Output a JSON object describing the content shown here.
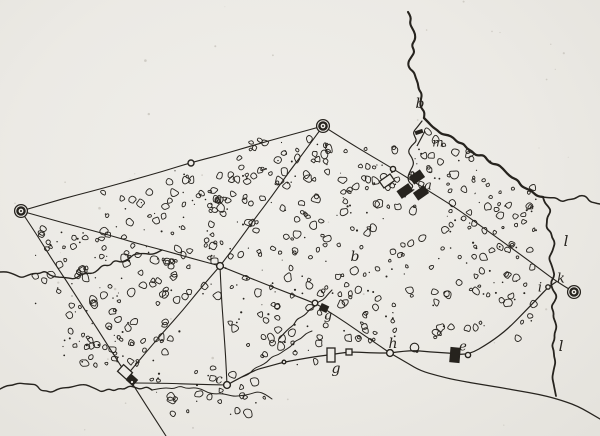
{
  "figure": {
    "kind": "hand-drawn-survey-sketch-map",
    "width": 600,
    "height": 436
  },
  "colors": {
    "paper": "#edebe6",
    "ink": "#26231e",
    "speckle": "#cfccc5"
  },
  "labels": [
    {
      "text": "a",
      "x": 428,
      "y": 186,
      "size": 13
    },
    {
      "text": "b",
      "x": 420,
      "y": 104,
      "size": 14
    },
    {
      "text": "b",
      "x": 355,
      "y": 257,
      "size": 14
    },
    {
      "text": "c",
      "x": 219,
      "y": 380,
      "size": 13
    },
    {
      "text": "g",
      "x": 328,
      "y": 316,
      "size": 13
    },
    {
      "text": "e",
      "x": 463,
      "y": 347,
      "size": 13
    },
    {
      "text": "g",
      "x": 336,
      "y": 369,
      "size": 14
    },
    {
      "text": "h",
      "x": 393,
      "y": 344,
      "size": 14
    },
    {
      "text": "i",
      "x": 540,
      "y": 288,
      "size": 13
    },
    {
      "text": "k",
      "x": 561,
      "y": 279,
      "size": 13
    },
    {
      "text": "l",
      "x": 566,
      "y": 242,
      "size": 15
    },
    {
      "text": "l",
      "x": 561,
      "y": 347,
      "size": 15
    },
    {
      "text": "m",
      "x": 438,
      "y": 143,
      "size": 12
    }
  ],
  "stations": [
    {
      "x": 21,
      "y": 211
    },
    {
      "x": 323,
      "y": 126
    },
    {
      "x": 574,
      "y": 292
    }
  ],
  "nodes": [
    {
      "x": 191,
      "y": 163,
      "r": 3.0
    },
    {
      "x": 393,
      "y": 169,
      "r": 2.6
    },
    {
      "x": 220,
      "y": 266,
      "r": 3.4
    },
    {
      "x": 227,
      "y": 385,
      "r": 3.4
    },
    {
      "x": 390,
      "y": 353,
      "r": 3.4
    },
    {
      "x": 468,
      "y": 355,
      "r": 2.6
    },
    {
      "x": 315,
      "y": 303,
      "r": 2.8
    },
    {
      "x": 548,
      "y": 287,
      "r": 2.2
    },
    {
      "x": 284,
      "y": 362,
      "r": 1.8
    },
    {
      "x": 132,
      "y": 382,
      "r": 1.8
    }
  ],
  "survey_lines": [
    {
      "pts": [
        [
          21,
          211
        ],
        [
          191,
          163
        ],
        [
          323,
          126
        ]
      ]
    },
    {
      "pts": [
        [
          21,
          211
        ],
        [
          220,
          266
        ]
      ]
    },
    {
      "pts": [
        [
          21,
          211
        ],
        [
          127,
          375
        ],
        [
          166,
          436
        ]
      ]
    },
    {
      "pts": [
        [
          323,
          126
        ],
        [
          220,
          266
        ]
      ]
    },
    {
      "pts": [
        [
          323,
          126
        ],
        [
          393,
          169
        ],
        [
          456,
          208
        ],
        [
          556,
          281
        ],
        [
          574,
          292
        ]
      ]
    },
    {
      "pts": [
        [
          220,
          266
        ],
        [
          315,
          303
        ],
        [
          324,
          308
        ],
        [
          390,
          353
        ]
      ]
    },
    {
      "pts": [
        [
          220,
          266
        ],
        [
          227,
          385
        ]
      ]
    },
    {
      "pts": [
        [
          220,
          266
        ],
        [
          127,
          375
        ]
      ]
    },
    {
      "pts": [
        [
          135,
          383
        ],
        [
          227,
          385
        ]
      ]
    }
  ],
  "roads": [
    {
      "pts": [
        [
          227,
          385
        ],
        [
          252,
          371
        ],
        [
          284,
          362
        ],
        [
          310,
          357
        ],
        [
          331,
          355
        ],
        [
          349,
          352
        ],
        [
          390,
          353
        ]
      ]
    },
    {
      "pts": [
        [
          390,
          353
        ],
        [
          410,
          350
        ],
        [
          430,
          352
        ],
        [
          468,
          355
        ],
        [
          490,
          343
        ],
        [
          508,
          329
        ],
        [
          524,
          312
        ],
        [
          538,
          298
        ],
        [
          548,
          287
        ],
        [
          556,
          282
        ]
      ]
    },
    {
      "pts": [
        [
          390,
          353
        ],
        [
          408,
          363
        ],
        [
          420,
          371
        ],
        [
          455,
          380
        ],
        [
          487,
          386
        ],
        [
          520,
          391
        ],
        [
          556,
          398
        ],
        [
          577,
          406
        ],
        [
          600,
          419
        ]
      ]
    }
  ],
  "streams": [
    {
      "name": "stream-b-upper",
      "w": 2.1,
      "amp": 3.4,
      "pts": [
        [
          408,
          12
        ],
        [
          415,
          40
        ],
        [
          409,
          68
        ],
        [
          420,
          95
        ],
        [
          424,
          118
        ]
      ]
    },
    {
      "name": "river-main",
      "w": 2.3,
      "amp": 2.8,
      "pts": [
        [
          424,
          118
        ],
        [
          443,
          133
        ],
        [
          468,
          147
        ],
        [
          492,
          163
        ],
        [
          517,
          181
        ],
        [
          543,
          197
        ]
      ]
    },
    {
      "name": "river-east-arm",
      "w": 1.5,
      "amp": 2.6,
      "pts": [
        [
          543,
          197
        ],
        [
          562,
          201
        ],
        [
          580,
          196
        ],
        [
          600,
          204
        ]
      ]
    },
    {
      "name": "river-l-south",
      "w": 1.8,
      "amp": 2.2,
      "pts": [
        [
          543,
          197
        ],
        [
          549,
          212
        ],
        [
          547,
          228
        ],
        [
          553,
          243
        ],
        [
          549,
          258
        ],
        [
          555,
          270
        ],
        [
          552,
          282
        ],
        [
          555,
          296
        ],
        [
          552,
          312
        ],
        [
          556,
          328
        ],
        [
          552,
          345
        ],
        [
          556,
          362
        ],
        [
          553,
          378
        ],
        [
          556,
          396
        ]
      ]
    },
    {
      "name": "village-brook",
      "w": 1.2,
      "amp": 1.8,
      "pts": [
        [
          422,
          121
        ],
        [
          412,
          131
        ],
        [
          417,
          141
        ],
        [
          408,
          152
        ],
        [
          414,
          164
        ],
        [
          407,
          176
        ],
        [
          413,
          187
        ],
        [
          405,
          197
        ]
      ]
    },
    {
      "name": "left-stream",
      "w": 1.4,
      "amp": 2.6,
      "pts": [
        [
          0,
          272
        ],
        [
          22,
          277
        ],
        [
          45,
          271
        ],
        [
          68,
          280
        ],
        [
          92,
          272
        ],
        [
          115,
          262
        ],
        [
          140,
          255
        ],
        [
          162,
          250
        ]
      ]
    },
    {
      "name": "bottom-stream",
      "w": 1.4,
      "amp": 2.6,
      "pts": [
        [
          0,
          389
        ],
        [
          25,
          384
        ],
        [
          52,
          391
        ],
        [
          80,
          385
        ],
        [
          108,
          391
        ],
        [
          135,
          386
        ],
        [
          152,
          390
        ]
      ]
    },
    {
      "name": "creek-g",
      "w": 1.1,
      "amp": 1.8,
      "pts": [
        [
          332,
          290
        ],
        [
          318,
          303
        ],
        [
          302,
          317
        ],
        [
          289,
          328
        ],
        [
          279,
          339
        ]
      ]
    }
  ],
  "wood_edges": [
    {
      "pts": [
        [
          152,
          390
        ],
        [
          180,
          386
        ],
        [
          208,
          393
        ],
        [
          235,
          396
        ],
        [
          258,
          391
        ],
        [
          272,
          399
        ]
      ]
    },
    {
      "pts": [
        [
          242,
          377
        ],
        [
          266,
          361
        ],
        [
          290,
          346
        ],
        [
          312,
          331
        ]
      ]
    }
  ],
  "buildings": [
    {
      "x": 387,
      "y": 181,
      "w": 13,
      "h": 8,
      "a": -35,
      "fill": "white"
    },
    {
      "x": 405,
      "y": 191,
      "w": 13,
      "h": 8,
      "a": -35,
      "fill": "black"
    },
    {
      "x": 417,
      "y": 177,
      "w": 12,
      "h": 8,
      "a": -35,
      "fill": "black"
    },
    {
      "x": 421,
      "y": 193,
      "w": 12,
      "h": 8,
      "a": -35,
      "fill": "black"
    },
    {
      "x": 455,
      "y": 355,
      "w": 9,
      "h": 14,
      "a": 5,
      "fill": "black"
    },
    {
      "x": 331,
      "y": 355,
      "w": 8,
      "h": 14,
      "a": 0,
      "fill": "white"
    },
    {
      "x": 349,
      "y": 352,
      "w": 6,
      "h": 6,
      "a": 0,
      "fill": "white"
    },
    {
      "x": 324,
      "y": 308,
      "w": 7,
      "h": 6,
      "a": 25,
      "fill": "black"
    },
    {
      "x": 125,
      "y": 372,
      "w": 12,
      "h": 9,
      "a": 42,
      "fill": "white"
    },
    {
      "x": 132,
      "y": 380,
      "w": 8,
      "h": 7,
      "a": 42,
      "fill": "black"
    }
  ],
  "flag_marker": {
    "pole": [
      [
        417,
        146
      ],
      [
        425,
        131
      ]
    ],
    "x": 419,
    "y": 132
  },
  "loop_marker": {
    "x": 414.5,
    "y": 347.5,
    "r": 4.3,
    "dot_x": 417,
    "dot_y": 351.5
  },
  "wood_regions": [
    {
      "x": 230,
      "y": 138,
      "w": 100,
      "h": 48,
      "count": 36
    },
    {
      "x": 168,
      "y": 168,
      "w": 65,
      "h": 40,
      "count": 18
    },
    {
      "x": 100,
      "y": 190,
      "w": 125,
      "h": 75,
      "count": 40
    },
    {
      "x": 35,
      "y": 228,
      "w": 70,
      "h": 90,
      "count": 30
    },
    {
      "x": 60,
      "y": 300,
      "w": 120,
      "h": 62,
      "count": 35
    },
    {
      "x": 105,
      "y": 255,
      "w": 115,
      "h": 45,
      "count": 28
    },
    {
      "x": 225,
      "y": 195,
      "w": 110,
      "h": 110,
      "count": 48
    },
    {
      "x": 335,
      "y": 140,
      "w": 88,
      "h": 165,
      "count": 62
    },
    {
      "x": 445,
      "y": 150,
      "w": 50,
      "h": 90,
      "count": 25
    },
    {
      "x": 495,
      "y": 185,
      "w": 45,
      "h": 70,
      "count": 20
    },
    {
      "x": 430,
      "y": 240,
      "w": 110,
      "h": 100,
      "count": 40
    },
    {
      "x": 230,
      "y": 305,
      "w": 100,
      "h": 60,
      "count": 25
    },
    {
      "x": 150,
      "y": 368,
      "w": 115,
      "h": 48,
      "count": 22
    },
    {
      "x": 70,
      "y": 342,
      "w": 70,
      "h": 26,
      "count": 10
    },
    {
      "x": 337,
      "y": 305,
      "w": 60,
      "h": 40,
      "count": 14
    },
    {
      "x": 424,
      "y": 130,
      "w": 20,
      "h": 55,
      "count": 8
    }
  ],
  "speckle_count": 48
}
